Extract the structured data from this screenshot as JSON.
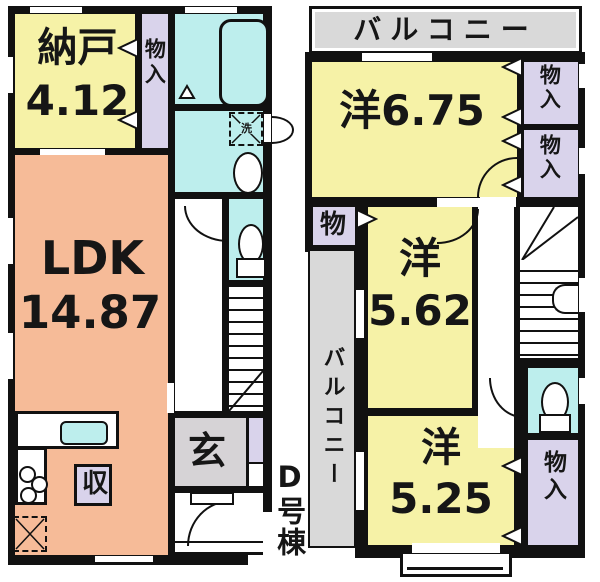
{
  "building": {
    "unit_label": "D号棟"
  },
  "colors": {
    "room_yellow": "#f6f2a7",
    "room_salmon": "#f6bb98",
    "wet_cyan": "#bdeeed",
    "closet_lavender": "#d9d3eb",
    "balcony_gray": "#d9d9d9",
    "entry_gray": "#d6d3d6",
    "wall": "#111111"
  },
  "floor1": {
    "storage_room": {
      "label": "納戸",
      "area": "4.12"
    },
    "closet": {
      "label": "物入"
    },
    "ldk": {
      "label": "LDK",
      "area": "14.87"
    },
    "entrance": {
      "label": "玄"
    },
    "storage_box": {
      "label": "収"
    },
    "washer": {
      "label": "洗"
    }
  },
  "floor2": {
    "balcony_top": {
      "label": "バルコニー"
    },
    "balcony_side": {
      "label": "バルコニー"
    },
    "bedroom_675": {
      "label": "洋6.75"
    },
    "bedroom_562": {
      "label": "洋",
      "area": "5.62"
    },
    "bedroom_525": {
      "label": "洋",
      "area": "5.25"
    },
    "closet_small": {
      "label": "物"
    },
    "closet_a": {
      "label": "物入"
    },
    "closet_b": {
      "label": "物入"
    },
    "closet_c": {
      "label": "物入"
    }
  }
}
